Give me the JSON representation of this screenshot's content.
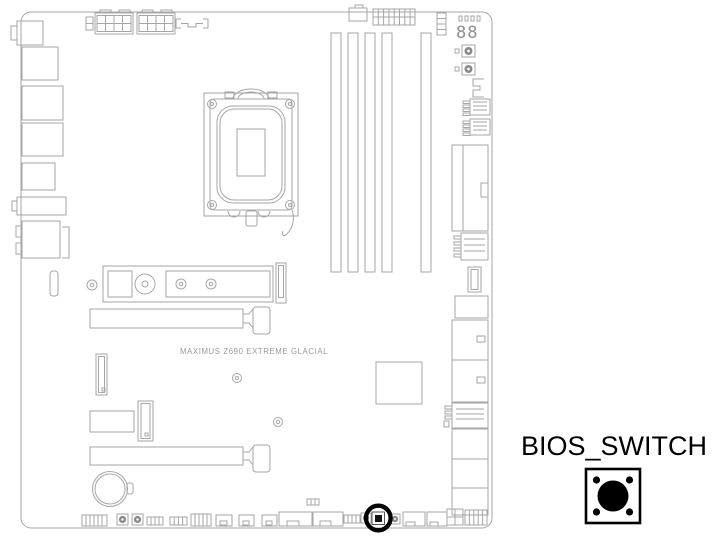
{
  "page": {
    "background": "#ffffff"
  },
  "diagram": {
    "board_name": "MAXIMUS Z690 EXTREME GLACIAL",
    "debug_display_value": "88",
    "highlighted_component": "bios-switch"
  },
  "legend": {
    "label": "BIOS_SWITCH",
    "icon": "push-button-switch-icon"
  },
  "colors": {
    "outline": "#a6a6a6",
    "board_text": "#9b9b9b",
    "highlight": "#000000",
    "button_fill": "#8a8a8a"
  }
}
